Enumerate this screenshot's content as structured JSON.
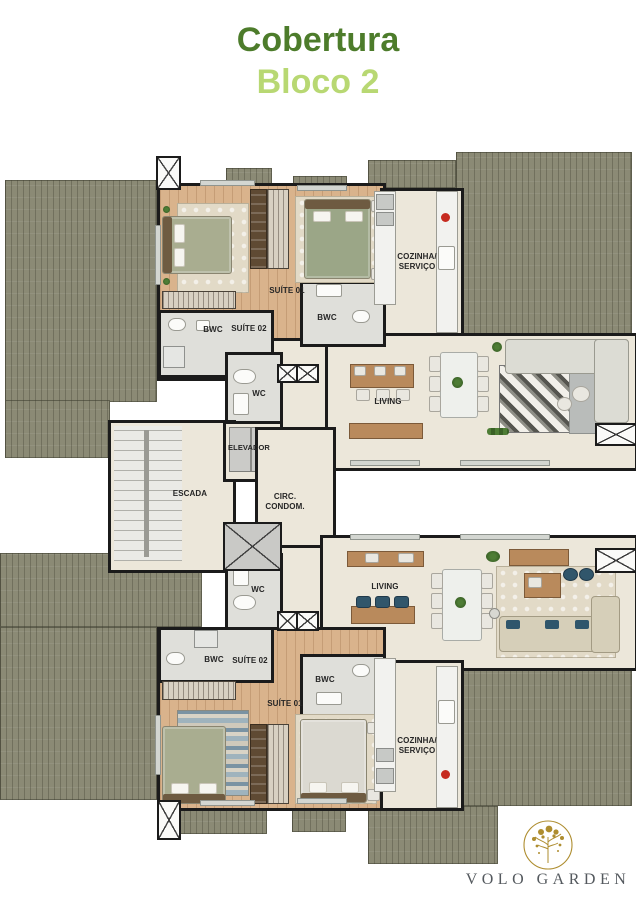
{
  "title": {
    "line1": "Cobertura",
    "line2": "Bloco 2"
  },
  "floor_plan": {
    "core": {
      "escada": "ESCADA",
      "elevador": "ELEVADOR",
      "circ_condom": "CIRC.\nCONDOM.",
      "wc_upper": "WC",
      "wc_lower": "WC"
    },
    "unit_upper": {
      "suite01": "SUÍTE 01",
      "suite02": "SUÍTE 02",
      "bwc_left": "BWC",
      "bwc_right": "BWC",
      "cozinha_servico": "COZINHA/\nSERVIÇO",
      "living": "LIVING"
    },
    "unit_lower": {
      "suite01": "SUÍTE 01",
      "suite02": "SUÍTE 02",
      "bwc_left": "BWC",
      "bwc_right": "BWC",
      "cozinha_servico": "COZINHA/\nSERVIÇO",
      "living": "LIVING"
    }
  },
  "logo": {
    "name": "VOLO GARDEN"
  },
  "icons": {
    "logo_tree": "gold-tree-in-circle",
    "shaft_symbol": "x-cross-duct"
  },
  "colors": {
    "title_primary": "#4d7c2b",
    "title_secondary": "#b8d873",
    "wall": "#1b1b1b",
    "terrace": "#8b8a75",
    "floor": "#ece7da",
    "wood_floor": "#d9b38c",
    "logo_gold": "#ae8d2f",
    "logo_text": "#54595e"
  }
}
